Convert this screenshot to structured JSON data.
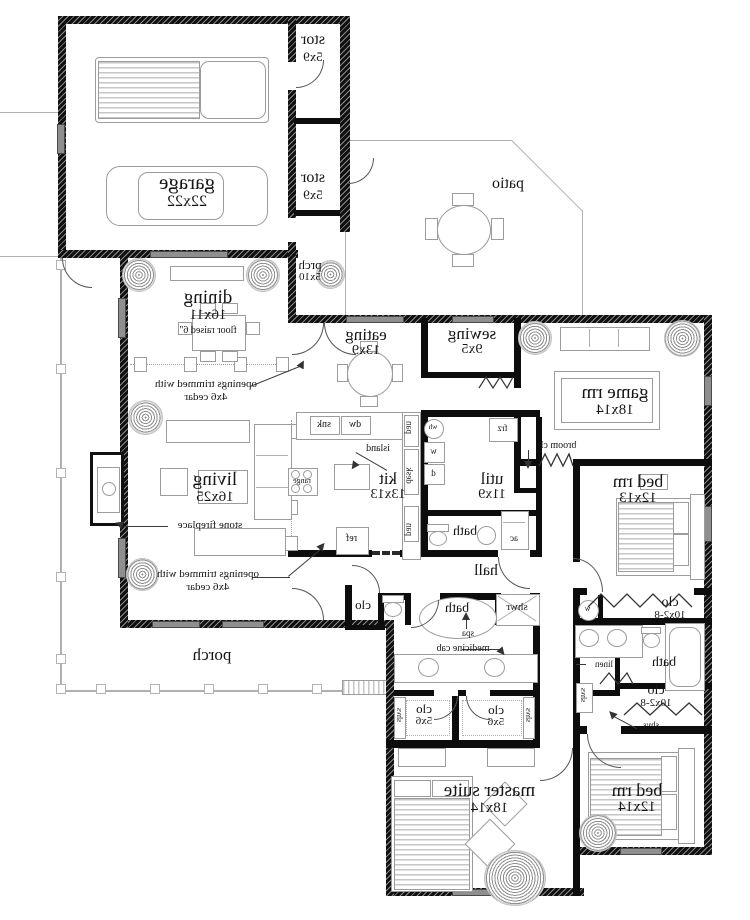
{
  "rooms": {
    "garage": {
      "name": "garage",
      "dims": "22x22"
    },
    "stor": {
      "name": "stor",
      "dims": "5x9"
    },
    "patio": {
      "name": "patio"
    },
    "prch": {
      "name": "prch",
      "dims": "5x10"
    },
    "dining": {
      "name": "dining",
      "dims": "16x11",
      "note": "floor raised 6\""
    },
    "eating": {
      "name": "eating",
      "dims": "13x9"
    },
    "sewing": {
      "name": "sewing",
      "dims": "9x5"
    },
    "game_rm": {
      "name": "game rm",
      "dims": "18x14"
    },
    "living": {
      "name": "living",
      "dims": "16x25"
    },
    "kit": {
      "name": "kit",
      "dims": "13x13"
    },
    "util": {
      "name": "util",
      "dims": "11x9"
    },
    "bed_rm_1": {
      "name": "bed rm",
      "dims": "12x13"
    },
    "bed_rm_2": {
      "name": "bed rm",
      "dims": "12x14"
    },
    "master": {
      "name": "master suite",
      "dims": "18x14"
    },
    "hall": {
      "name": "hall"
    },
    "porch": {
      "name": "porch"
    },
    "bath": {
      "name": "bath"
    },
    "shwr": {
      "name": "shwr"
    },
    "clo": {
      "name": "clo"
    },
    "clo_tall": {
      "name": "clo",
      "dims": "10x2-8"
    },
    "clo_small": {
      "name": "clo",
      "dims": "5x6"
    }
  },
  "annotations": {
    "openings_line1": "openings trimmed with",
    "openings_line2": "4x6 cedar",
    "fireplace": "stone fireplace",
    "island": "island",
    "broom_clo": "broom clo",
    "medicine_cab": "medicine cab",
    "spa": "spa",
    "linen": "linen",
    "shvs": "shvs"
  },
  "fixtures": {
    "dw": "dw",
    "snk": "snk",
    "ref": "ref",
    "range": "range",
    "frz": "frz",
    "wh": "wh",
    "w": "w",
    "d": "d",
    "ac": "ac",
    "pan": "pan",
    "desk": "desk"
  }
}
